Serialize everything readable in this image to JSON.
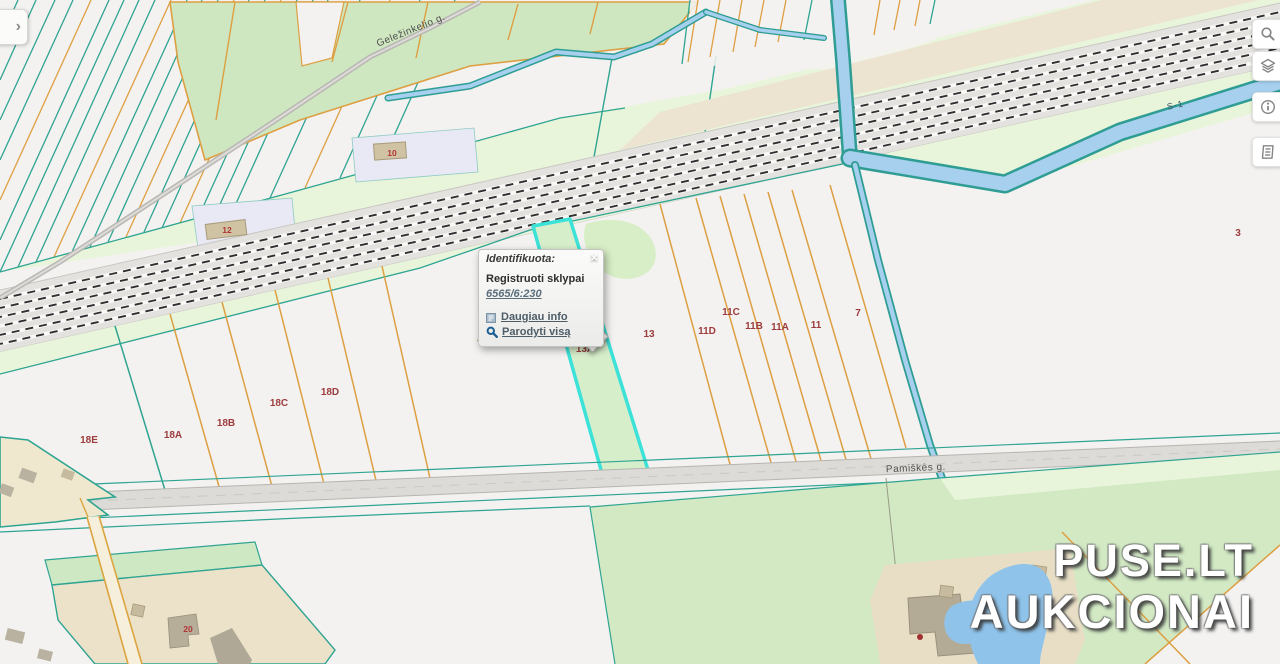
{
  "map": {
    "place_label": "Jovarų k.",
    "streets": {
      "gelezinkelio": "Geležinkelio g.",
      "pamiskes": "Pamiškės g.",
      "canal": "S-1"
    },
    "parcels": [
      {
        "text": "18E"
      },
      {
        "text": "18A"
      },
      {
        "text": "18B"
      },
      {
        "text": "18C"
      },
      {
        "text": "18D"
      },
      {
        "text": "13A"
      },
      {
        "text": "13"
      },
      {
        "text": "11D"
      },
      {
        "text": "11C"
      },
      {
        "text": "11B"
      },
      {
        "text": "11A"
      },
      {
        "text": "11"
      },
      {
        "text": "7"
      },
      {
        "text": "3"
      },
      {
        "text": "10"
      },
      {
        "text": "12"
      },
      {
        "text": "20"
      }
    ]
  },
  "popup": {
    "title": "Identifikuota:",
    "close": "×",
    "layer_title": "Registruoti sklypai",
    "feature_link": "6565/6:230",
    "more_info": "Daugiau info",
    "show_all": "Parodyti visą"
  },
  "toolbar": {
    "buttons": [
      {
        "icon": "search"
      },
      {
        "icon": "layers"
      },
      {
        "icon": "info"
      },
      {
        "icon": "legend"
      }
    ]
  },
  "sidebar_toggle": {
    "chevron": "›"
  },
  "watermark": {
    "line1": "PUSE.LT",
    "line2": "AUKCIONAI"
  },
  "colors": {
    "selection_cyan": "#3ce1d8",
    "parcel_border_orange": "#dd9f42",
    "boundary_teal": "#2fa492",
    "water_fill": "#a6d0ee",
    "label_red": "#9c3c3c"
  }
}
